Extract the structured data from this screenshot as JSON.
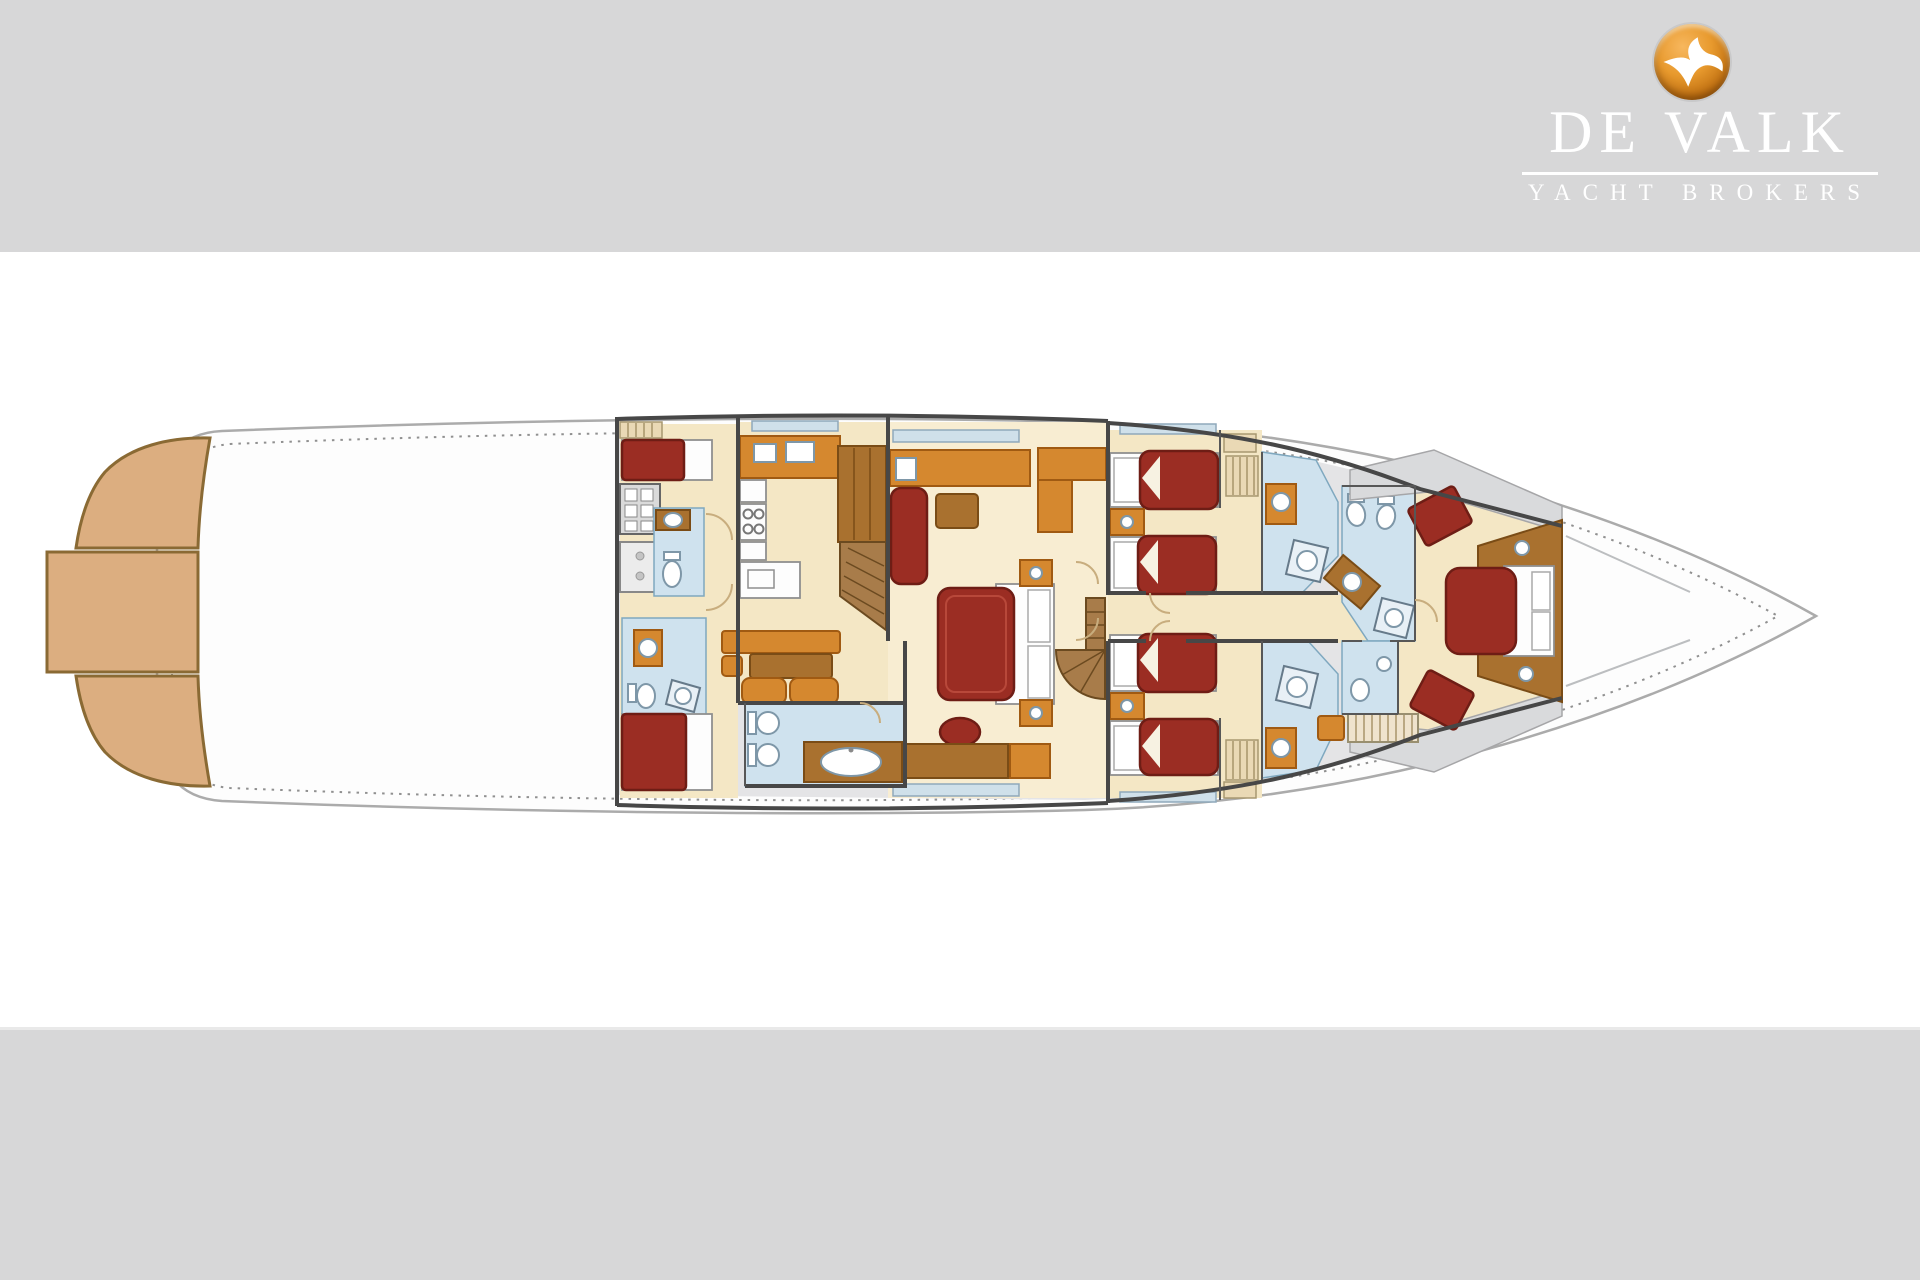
{
  "page": {
    "background_gray": "#d7d7d8",
    "canvas_white": "#ffffff"
  },
  "logo": {
    "brand": "DE VALK",
    "tagline": "YACHT BROKERS",
    "text_color": "#ffffff",
    "badge_outer": "#8a4d10",
    "badge_inner": "#f7b75e",
    "bird_icon": "falcon-icon"
  },
  "floorplan": {
    "subject": "motor yacht lower-deck accommodation plan, bow pointing right",
    "colors": {
      "pagegray": "#d7d7d8",
      "hullline": "#ababab",
      "sidedeck": "#e4e4e6",
      "graywedge": "#d9dadc",
      "teak": "#dcae80",
      "teakdk": "#8a6a34",
      "cream": "#f4e7c5",
      "cream2": "#f8edd2",
      "bath": "#cfe2ee",
      "bathline": "#7fa8bf",
      "window": "#cfe0ea",
      "orange": "#d5882f",
      "orangedk": "#a05a12",
      "brown": "#a9712f",
      "browndk": "#7a4c16",
      "wood": "#a87c4a",
      "bedred": "#9b2d23",
      "bedreddk": "#6e1d15",
      "wall": "#474747"
    },
    "counts": {
      "berths": 9,
      "double_beds": 2,
      "single_beds": 5,
      "wet_rooms": 6
    },
    "rooms": [
      {
        "name": "swim-platform",
        "features": [
          "three teak steps at stern"
        ]
      },
      {
        "name": "aft-deck",
        "features": [
          "open white deck"
        ]
      },
      {
        "name": "crew-quarters",
        "features": [
          "2 single berths",
          "2 shower rooms",
          "washer",
          "counter"
        ]
      },
      {
        "name": "galley",
        "features": [
          "cabinets",
          "fridge",
          "stove with 4 burners",
          "sink counter",
          "pantry",
          "companionway"
        ]
      },
      {
        "name": "dinette",
        "features": [
          "table",
          "bench",
          "2 chairs"
        ]
      },
      {
        "name": "day-head",
        "features": [
          "toilet",
          "bidet",
          "double vanity"
        ]
      },
      {
        "name": "master-stateroom",
        "features": [
          "centerline double bed",
          "sofa",
          "ottoman",
          "desk",
          "stool",
          "wardrobe",
          "2 nightstands"
        ]
      },
      {
        "name": "staircase",
        "features": [
          "curved companionway steps"
        ]
      },
      {
        "name": "guest-cabin-aft",
        "features": [
          "2 single beds",
          "nightstand",
          "ensuite shower room"
        ]
      },
      {
        "name": "guest-cabin-forward",
        "features": [
          "2 single beds",
          "nightstand",
          "ensuite shower room"
        ]
      },
      {
        "name": "vip-cabin",
        "features": [
          "double bed facing bow",
          "2 seats",
          "ensuite bathroom",
          "deck ladder"
        ]
      },
      {
        "name": "foredeck",
        "features": [
          "pointed bow",
          "deck seams"
        ]
      }
    ]
  }
}
